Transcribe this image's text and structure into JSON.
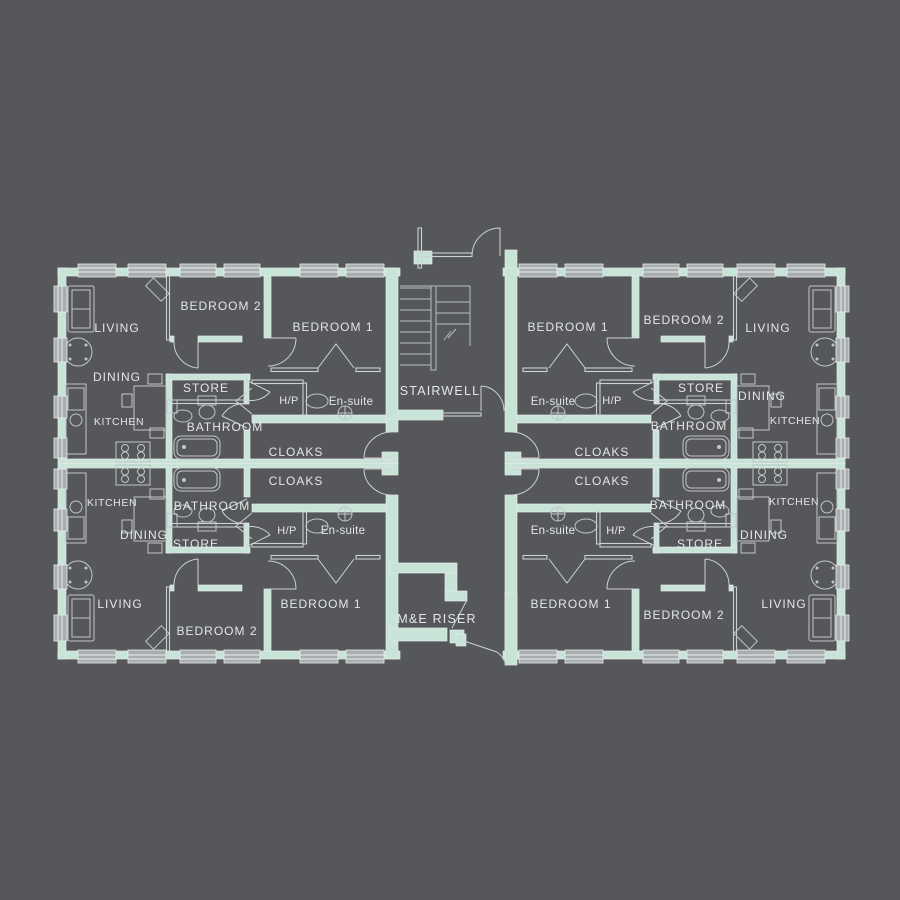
{
  "plan": {
    "title": "apartment-floor-plan",
    "top_left": {
      "living": "LIVING",
      "bedroom2": "BEDROOM 2",
      "bedroom1": "BEDROOM 1",
      "dining": "DINING",
      "store": "STORE",
      "hp": "H/P",
      "ensuite": "En-suite",
      "kitchen": "KITCHEN",
      "bathroom": "BATHROOM",
      "cloaks": "CLOAKS"
    },
    "top_right": {
      "bedroom1": "BEDROOM 1",
      "bedroom2": "BEDROOM 2",
      "living": "LIVING",
      "ensuite": "En-suite",
      "hp": "H/P",
      "store": "STORE",
      "dining": "DINING",
      "bathroom": "BATHROOM",
      "kitchen": "KITCHEN",
      "cloaks": "CLOAKS"
    },
    "bottom_left": {
      "cloaks": "CLOAKS",
      "kitchen": "KITCHEN",
      "bathroom": "BATHROOM",
      "dining": "DINING",
      "store": "STORE",
      "hp": "H/P",
      "ensuite": "En-suite",
      "living": "LIVING",
      "bedroom2": "BEDROOM 2",
      "bedroom1": "BEDROOM 1"
    },
    "bottom_right": {
      "cloaks": "CLOAKS",
      "ensuite": "En-suite",
      "hp": "H/P",
      "bathroom": "BATHROOM",
      "kitchen": "KITCHEN",
      "dining": "DINING",
      "store": "STORE",
      "bedroom1": "BEDROOM 1",
      "bedroom2": "BEDROOM 2",
      "living": "LIVING"
    },
    "center": {
      "stairwell": "STAIRWELL",
      "riser": "M&E RISER"
    },
    "colors": {
      "background": "#55575b",
      "wall": "#c8e4d8",
      "line": "#cdd1d1",
      "text": "#e4e6e6"
    }
  }
}
